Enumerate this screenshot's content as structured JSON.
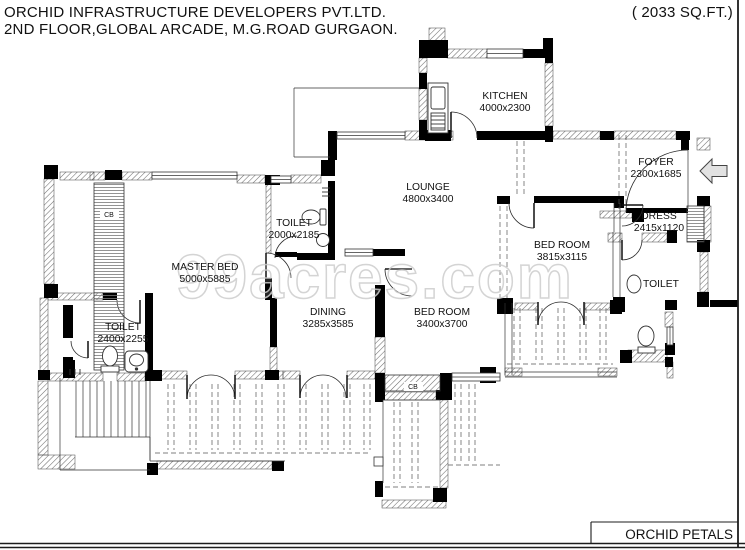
{
  "title_block": {
    "company_line1": "ORCHID INFRASTRUCTURE DEVELOPERS PVT.LTD.",
    "company_line2": "2ND FLOOR,GLOBAL ARCADE, M.G.ROAD GURGAON.",
    "area_label": "( 2033 SQ.FT.)",
    "project_name": "ORCHID PETALS"
  },
  "watermark_text": "99acres.com",
  "rooms": [
    {
      "name": "KITCHEN",
      "dims": "4000x2300"
    },
    {
      "name": "FOYER",
      "dims": "2300x1685"
    },
    {
      "name": "LOUNGE",
      "dims": "4800x3400"
    },
    {
      "name": "TOILET",
      "dims": "2000x2185"
    },
    {
      "name": "MASTER BED",
      "dims": "5000x5885"
    },
    {
      "name": "BED ROOM",
      "dims": "3815x3115"
    },
    {
      "name": "DRESS",
      "dims": "2415x1120"
    },
    {
      "name": "TOILET",
      "dims": ""
    },
    {
      "name": "DINING",
      "dims": "3285x3585"
    },
    {
      "name": "BED ROOM",
      "dims": "3400x3700"
    },
    {
      "name": "TOILET",
      "dims": "2400x2255"
    }
  ],
  "wardrobe_labels": [
    {
      "label": "CB"
    },
    {
      "label": "CB"
    }
  ],
  "colors": {
    "ink": "#111111",
    "wall_black": "#000000",
    "hatch_stroke": "#6e6e6e",
    "thin_line": "#333333",
    "dashed_line": "#555555",
    "watermark": "#cdcdcd",
    "background": "#ffffff"
  }
}
